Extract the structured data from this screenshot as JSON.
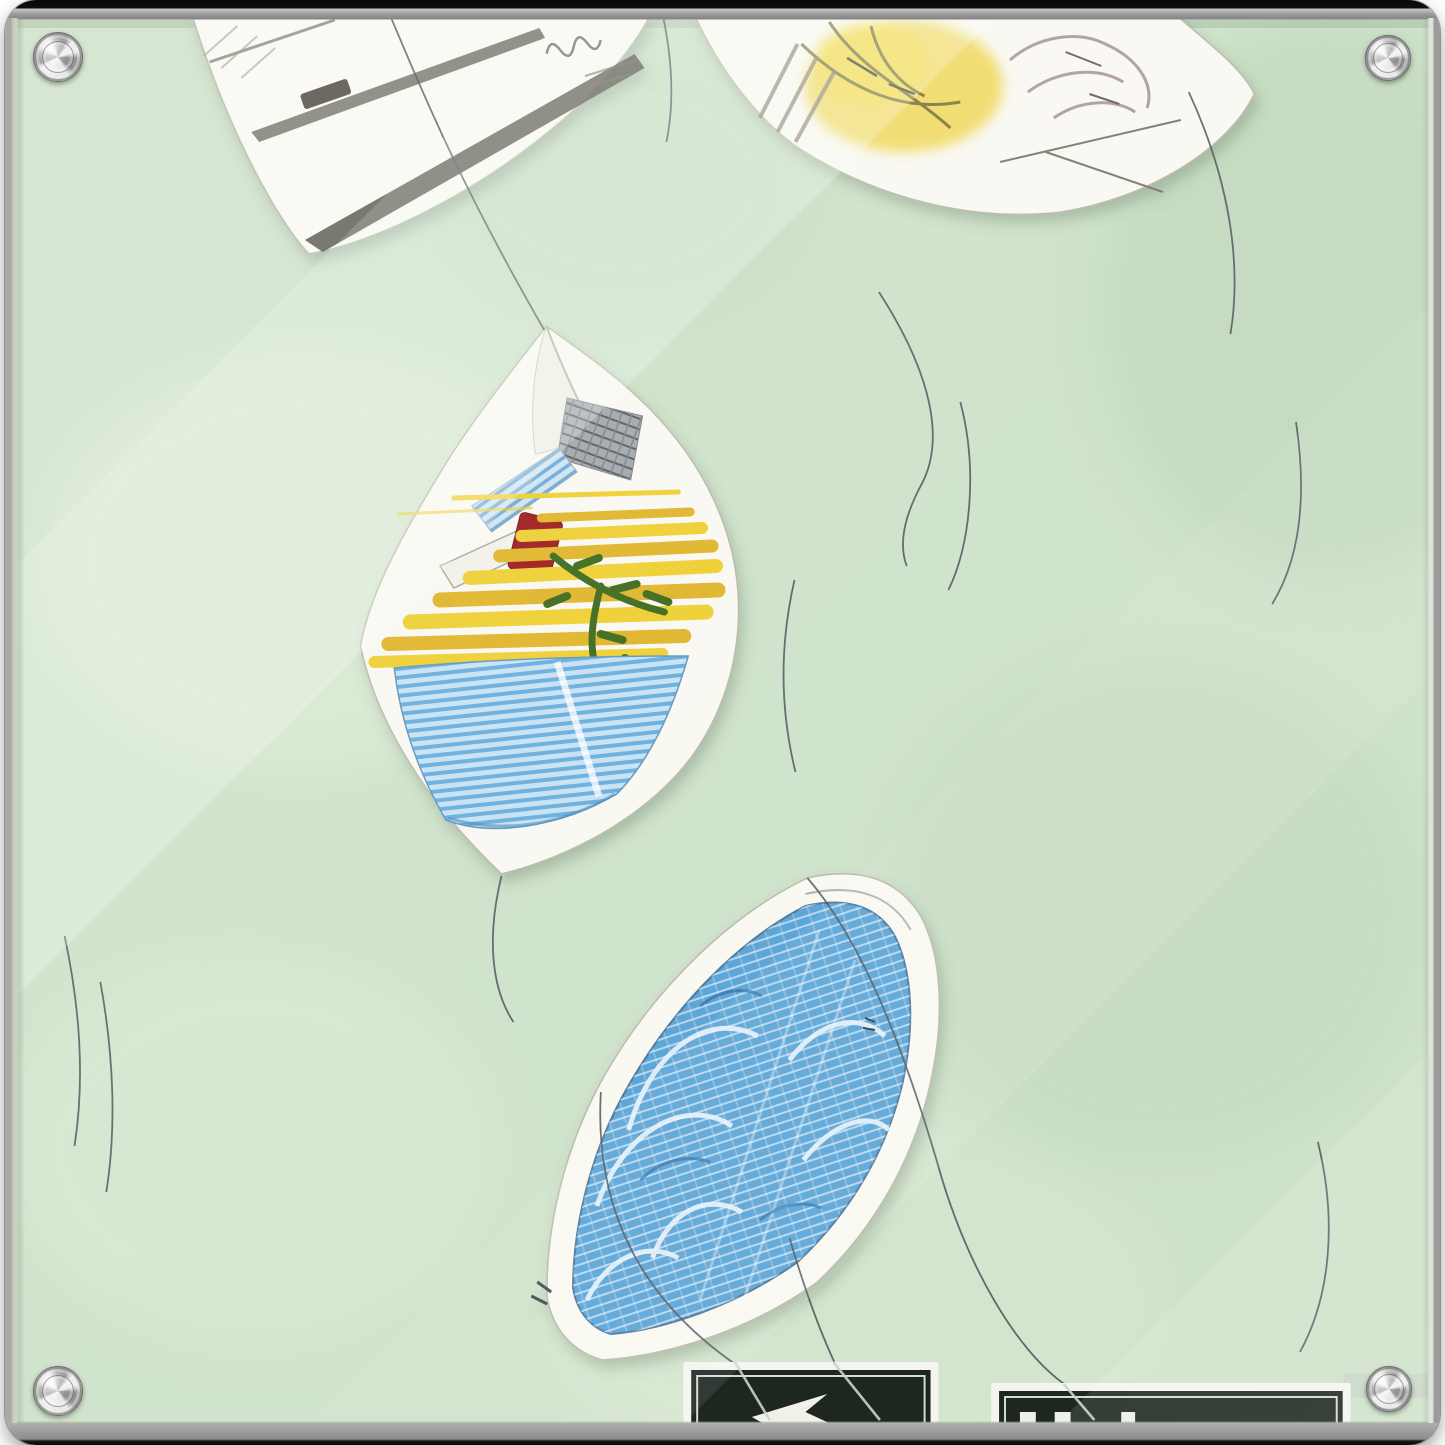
{
  "scene": {
    "kind": "acrylic glass wall-art print, mounted with four silver stand-off screws",
    "glare": "diagonal glass reflections running from upper left toward lower right",
    "screws": [
      "top-left",
      "top-right",
      "bottom-left",
      "bottom-right"
    ]
  },
  "artwork": {
    "background": "textured mint-green wash with lighter patches",
    "papers": [
      {
        "id": "top-left",
        "content": "pencil sketch: long tapered rods, small dark bar, spring doodle, tiny scribbles (cropped by frame)"
      },
      {
        "id": "top-right",
        "content": "white sheet with yellow wash blob, olive scribbles and mauve-gray scribble mass (cropped by frame)"
      },
      {
        "id": "middle",
        "content": "kite-shaped sheet: gray hatched axe head with striped handle, pale handle with dark-red block, yellow stripe pyramid, dark-green sprig, blue hatched wedge"
      },
      {
        "id": "bottom",
        "content": "leaf-shaped sheet filled with blue crosshatched arch study and white swirl lines"
      }
    ],
    "strings": "thin curved threads linking and drifting between the sheets",
    "signs": [
      {
        "id": "left",
        "glyph": "white arrow fragment on dark-green sign (bottom edge cropped)"
      },
      {
        "id": "right",
        "glyph": "tops of three white letters on dark-green sign (bottom edge cropped)"
      }
    ]
  },
  "colors": {
    "bg": "#cfe2ca",
    "bg-light": "#e0edd7",
    "bg-dark": "#bcd3b8",
    "paper": "#f9f8f1",
    "pencil": "#6a6a60",
    "pencil-dark": "#514f47",
    "yellow": "#eecf30",
    "yellow-deep": "#e0b52c",
    "blue-paper": "#58a3d6",
    "red": "#9e1f1f",
    "green-branch": "#3c6b1c",
    "sign-green": "#1d2720",
    "sign-white": "#f4f4f0",
    "string": "#4a555a",
    "band": "#c9d6c6",
    "metal-dark": "#6e6e6e"
  }
}
